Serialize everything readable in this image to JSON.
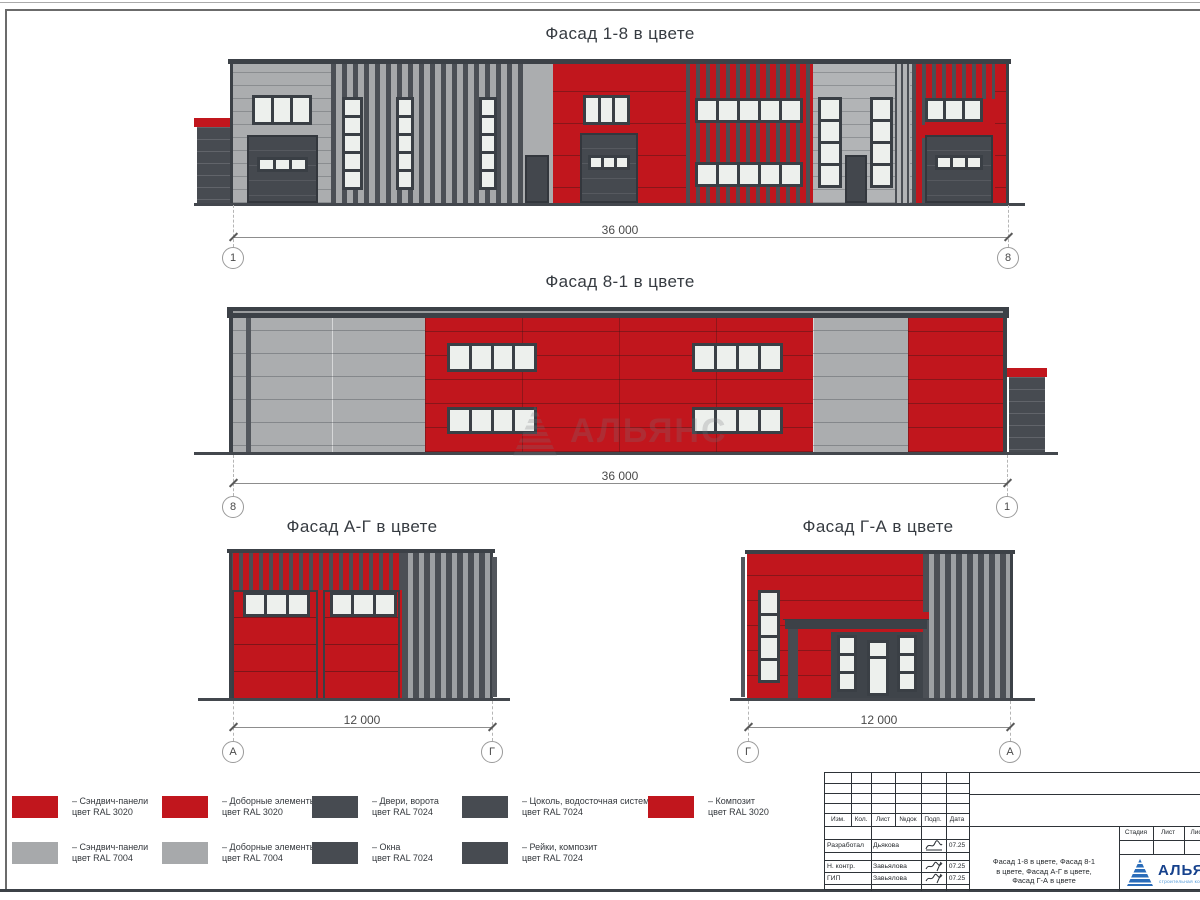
{
  "colors": {
    "ral3020_red": "#C1161D",
    "ral7004_gray": "#A7A9AB",
    "ral7024_graphite": "#474B51"
  },
  "facades": [
    {
      "title": "Фасад 1-8 в цвете",
      "dimension": "36 000",
      "axis_left": "1",
      "axis_right": "8"
    },
    {
      "title": "Фасад 8-1 в цвете",
      "dimension": "36 000",
      "axis_left": "8",
      "axis_right": "1"
    },
    {
      "title": "Фасад А-Г в цвете",
      "dimension": "12 000",
      "axis_left": "А",
      "axis_right": "Г"
    },
    {
      "title": "Фасад Г-А в цвете",
      "dimension": "12 000",
      "axis_left": "Г",
      "axis_right": "А"
    }
  ],
  "legend": [
    {
      "swatch": "red",
      "line1": "– Сэндвич-панели",
      "line2": "цвет RAL 3020"
    },
    {
      "swatch": "gray",
      "line1": "– Сэндвич-панели",
      "line2": "цвет RAL 7004"
    },
    {
      "swatch": "red",
      "line1": "– Доборные элементы",
      "line2": "цвет RAL 3020"
    },
    {
      "swatch": "gray",
      "line1": "– Доборные элементы",
      "line2": "цвет RAL 7004"
    },
    {
      "swatch": "dark",
      "line1": "– Двери, ворота",
      "line2": "цвет RAL 7024"
    },
    {
      "swatch": "dark",
      "line1": "– Окна",
      "line2": "цвет RAL 7024"
    },
    {
      "swatch": "dark",
      "line1": "– Цоколь, водосточная система",
      "line2": "цвет RAL 7024"
    },
    {
      "swatch": "dark",
      "line1": "– Рейки, композит",
      "line2": "цвет RAL 7024"
    },
    {
      "swatch": "red",
      "line1": "– Композит",
      "line2": "цвет RAL 3020"
    }
  ],
  "titleblock": {
    "columns": [
      "Изм.",
      "Кол.",
      "Лист",
      "№док",
      "Подп.",
      "Дата"
    ],
    "rows": [
      {
        "role": "Разработал",
        "name": "Дьякова",
        "date": "07.25"
      },
      {
        "role": "Н. контр.",
        "name": "Завьялова",
        "date": "07.25"
      },
      {
        "role": "ГИП",
        "name": "Завьялова",
        "date": "07.25"
      }
    ],
    "doc_line1": "Фасад 1-8 в цвете, Фасад 8-1",
    "doc_line2": "в цвете, Фасад А-Г в цвете,",
    "doc_line3": "Фасад Г-А в цвете",
    "stage_columns": [
      "Стадия",
      "Лист",
      "Листов"
    ],
    "logo_text": "АЛЬЯНС",
    "logo_subtext": "строительная компания"
  },
  "watermark": {
    "text": "АЛЬЯНС"
  }
}
